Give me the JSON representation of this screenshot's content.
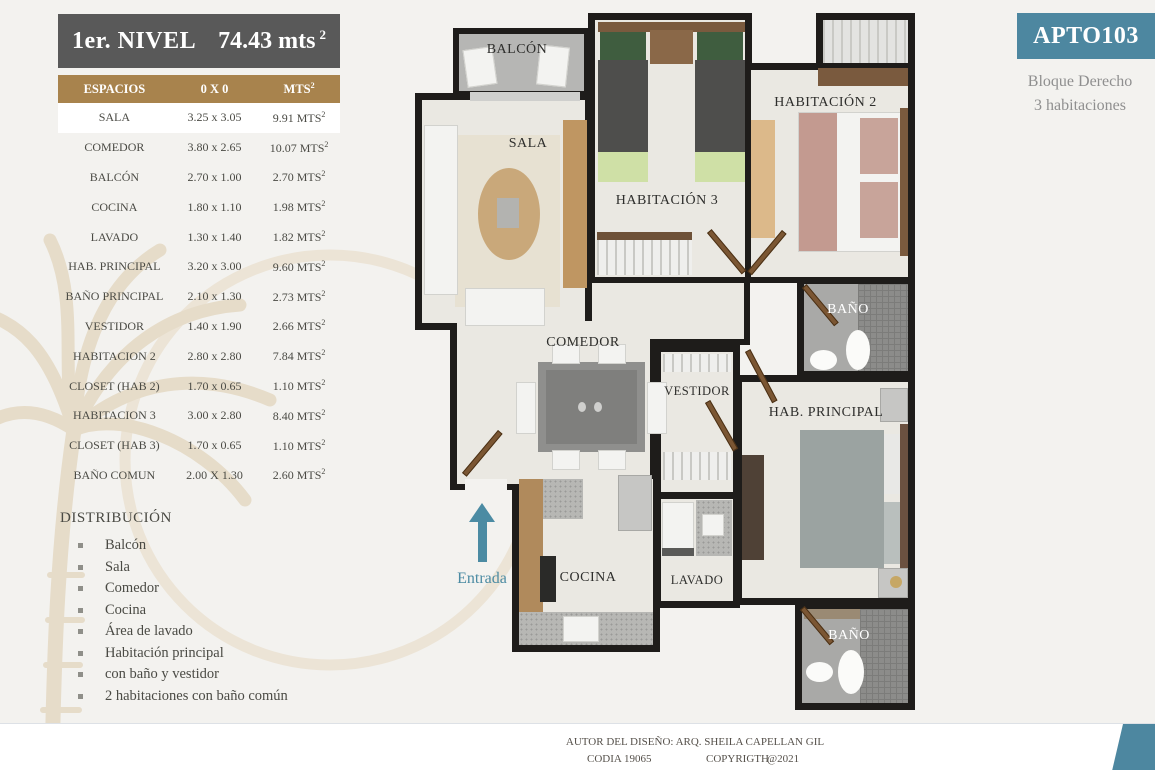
{
  "title": {
    "level": "1er. NIVEL",
    "area_value": "74.43 mts",
    "area_sup": "2"
  },
  "table": {
    "headers": {
      "col1": "ESPACIOS",
      "col2": "0 X 0"
    },
    "unit": "MTS",
    "sup": "2",
    "rows": [
      {
        "espacio": "SALA",
        "dims": "3.25 x 3.05",
        "mts": "9.91"
      },
      {
        "espacio": "COMEDOR",
        "dims": "3.80 x 2.65",
        "mts": "10.07"
      },
      {
        "espacio": "BALCÓN",
        "dims": "2.70 x 1.00",
        "mts": "2.70"
      },
      {
        "espacio": "COCINA",
        "dims": "1.80 x 1.10",
        "mts": "1.98"
      },
      {
        "espacio": "LAVADO",
        "dims": "1.30 x 1.40",
        "mts": "1.82"
      },
      {
        "espacio": "HAB. PRINCIPAL",
        "dims": "3.20 x 3.00",
        "mts": "9.60"
      },
      {
        "espacio": "BAÑO  PRINCIPAL",
        "dims": "2.10 x 1.30",
        "mts": "2.73"
      },
      {
        "espacio": "VESTIDOR",
        "dims": "1.40 x 1.90",
        "mts": "2.66"
      },
      {
        "espacio": "HABITACION 2",
        "dims": "2.80 x  2.80",
        "mts": "7.84"
      },
      {
        "espacio": "CLOSET (HAB  2)",
        "dims": "1.70 x 0.65",
        "mts": "1.10"
      },
      {
        "espacio": "HABITACION 3",
        "dims": "3.00 x 2.80",
        "mts": "8.40"
      },
      {
        "espacio": "CLOSET (HAB 3)",
        "dims": "1.70 x 0.65",
        "mts": "1.10"
      },
      {
        "espacio": "BAÑO COMUN",
        "dims": "2.00 X 1.30",
        "mts": "2.60"
      }
    ]
  },
  "distribution": {
    "title": "DISTRIBUCIÓN",
    "items": [
      "Balcón",
      "Sala",
      "Comedor",
      "Cocina",
      "Área de lavado",
      "Habitación principal",
      "con baño y vestidor",
      "2 habitaciones con baño común"
    ]
  },
  "apartment": {
    "code": "APTO103",
    "block": "Bloque Derecho",
    "rooms": "3 habitaciones"
  },
  "plan": {
    "labels": {
      "balcon": "BALCÓN",
      "sala": "SALA",
      "hab3": "HABITACIÓN 3",
      "hab2": "HABITACIÓN 2",
      "bano_top": "BAÑO",
      "comedor": "COMEDOR",
      "vestidor": "VESTIDOR",
      "hab_principal": "HAB. PRINCIPAL",
      "cocina": "COCINA",
      "lavado": "LAVADO",
      "bano_bottom": "BAÑO",
      "entrada": "Entrada"
    }
  },
  "footer": {
    "author": "AUTOR DEL DISEÑO: ARQ. SHEILA CAPELLAN GIL",
    "codia": "CODIA 19065",
    "copyright": "COPYRIGTH",
    "year": "@2021"
  },
  "colors": {
    "accent_gold": "#a8834d",
    "accent_teal": "#4d87a0",
    "title_gray": "#595959",
    "wall_black": "#1e1c1a",
    "watermark_tan": "#e4d9c6",
    "entrada_teal": "#4b8ba3"
  }
}
